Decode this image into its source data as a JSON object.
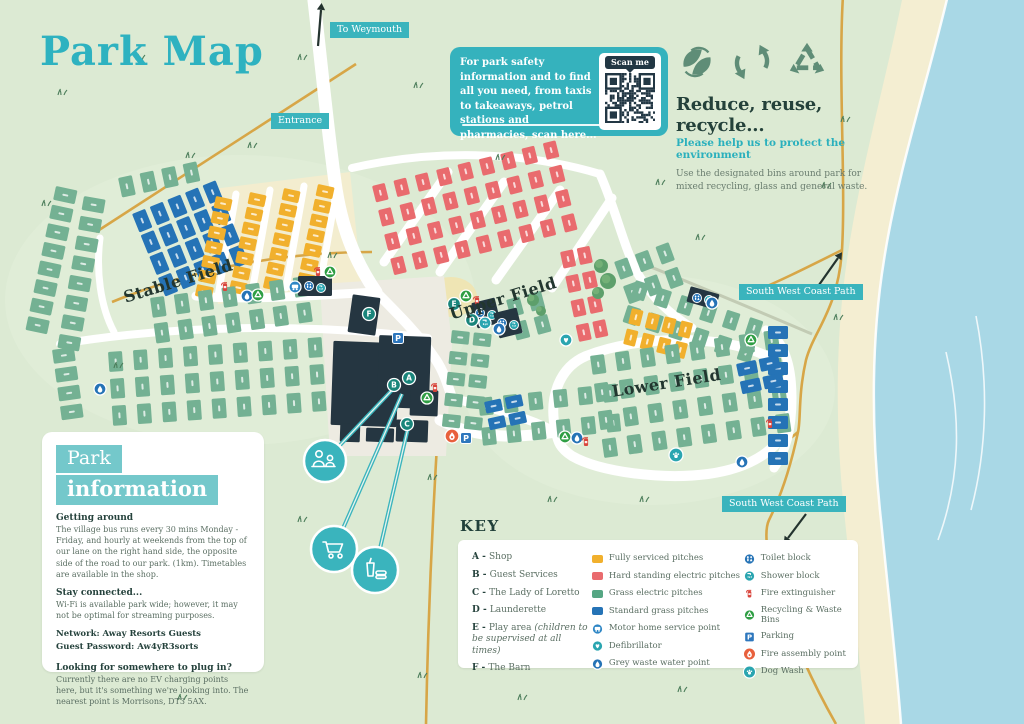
{
  "page": {
    "title": "Park Map"
  },
  "qr_panel": {
    "text": "For park safety information and to find all you need, from taxis to takeaways, petrol stations and pharmacies, scan here...",
    "scan_label": "Scan me"
  },
  "recycle_panel": {
    "heading": "Reduce, reuse, recycle...",
    "subheading": "Please help us to protect the environment",
    "body": "Use the designated bins around park for mixed recycling, glass and general waste."
  },
  "park_info": {
    "title_line1": "Park",
    "title_line2": "information",
    "sections": [
      {
        "heading": "Getting around",
        "body": "The village bus runs every 30 mins Monday - Friday, and hourly at weekends from the top of our lane on the right hand side, the opposite side of the road to our park. (1km). Timetables are available in the shop."
      },
      {
        "heading": "Stay connected...",
        "body": "Wi-Fi is available park wide; however, it may not be optimal for streaming purposes."
      },
      {
        "bold": [
          "Network: Away Resorts Guests",
          "Guest Password: Aw4yR3sorts"
        ]
      },
      {
        "heading": "Looking for somewhere to plug in?",
        "body": "Currently there are no EV charging points here, but it's something we're looking into. The nearest point is Morrisons, DT3 5AX."
      }
    ]
  },
  "key": {
    "title": "KEY",
    "facilities": [
      {
        "letter": "A",
        "label": "Shop"
      },
      {
        "letter": "B",
        "label": "Guest Services"
      },
      {
        "letter": "C",
        "label": "The Lady of Loretto"
      },
      {
        "letter": "D",
        "label": "Launderette"
      },
      {
        "letter": "E",
        "label": "Play area",
        "note": "(children to be supervised at all times)"
      },
      {
        "letter": "F",
        "label": "The Barn"
      }
    ],
    "legend_pitches": [
      {
        "swatch": "yellow",
        "label": "Fully serviced pitches"
      },
      {
        "swatch": "red",
        "label": "Hard standing electric pitches"
      },
      {
        "swatch": "green",
        "label": "Grass electric pitches"
      },
      {
        "swatch": "blue",
        "label": "Standard grass pitches"
      },
      {
        "icon": "motorhome",
        "label": "Motor home service point"
      },
      {
        "icon": "defib",
        "label": "Defibrillator"
      },
      {
        "icon": "greywaste",
        "label": "Grey waste water point"
      }
    ],
    "legend_icons": [
      {
        "icon": "toilet",
        "label": "Toilet block"
      },
      {
        "icon": "shower",
        "label": "Shower block"
      },
      {
        "icon": "fireext",
        "label": "Fire extinguisher"
      },
      {
        "icon": "recycling",
        "label": "Recycling & Waste Bins"
      },
      {
        "icon": "parking",
        "label": "Parking"
      },
      {
        "icon": "fireassembly",
        "label": "Fire assembly point"
      },
      {
        "icon": "dogwash",
        "label": "Dog Wash"
      }
    ]
  },
  "map": {
    "colors": {
      "land": "#dcead3",
      "sea": "#a9d8e6",
      "beach": "#f4eed2",
      "road": "#ffffff",
      "tan": "#d7a647",
      "hedge_gray": "#c2cbb4",
      "building": "#253641",
      "apron": "#edebe2",
      "yellow": "#f1b02d",
      "red": "#e96b6e",
      "green": "#74b193",
      "blue": "#2573b6",
      "key_green": "#55a683",
      "teal": "#3ab4bd",
      "marker": "#19857b",
      "tuft": "#4a7c59"
    },
    "chips": [
      {
        "text": "To Weymouth",
        "x": 330,
        "y": 22
      },
      {
        "text": "Entrance",
        "x": 271,
        "y": 113
      },
      {
        "text": "South West Coast Path",
        "x": 739,
        "y": 284
      },
      {
        "text": "South West Coast Path",
        "x": 722,
        "y": 496
      }
    ],
    "field_labels": [
      {
        "text": "Stable Field",
        "x": 124,
        "y": 288,
        "rot": -17
      },
      {
        "text": "Upper Field",
        "x": 450,
        "y": 305,
        "rot": -17
      },
      {
        "text": "Lower Field",
        "x": 612,
        "y": 382,
        "rot": -9
      }
    ],
    "sea_path": "M948,-5 C928,80 898,170 884,260 C871,340 871,430 881,520 C889,600 897,670 901,724 L1030,724 L1030,-5 Z",
    "beach_path": "M903,-5 C886,80 860,170 847,260 C835,340 835,430 845,520 C853,600 861,670 865,724 L1030,724 L1030,-5 Z",
    "foam_path": "M948,-5 C928,80 898,170 884,260 C871,340 871,430 881,520 C889,600 897,670 901,724",
    "waves": [
      "M946,352 C962,420 960,480 938,540",
      "M976,316 C989,382 987,450 971,510"
    ],
    "cream_patches": [
      {
        "d": "M205,190 L350,172 L362,286 L218,304 Z",
        "fill": "#f3edcf"
      },
      {
        "d": "M425,297 a26,20 0 1,0 52,0 a26,20 0 1,0 -52,0",
        "fill": "#efe5b4"
      }
    ],
    "apron_path": "M320,284 L444,276 L452,344 L446,456 L330,456 Z",
    "roads": [
      {
        "d": "M313,-8 C321,60 327,125 335,182 C341,226 354,260 376,292",
        "w": 13
      },
      {
        "d": "M196,296 C250,301 320,295 376,292",
        "w": 9
      },
      {
        "d": "M236,194 L218,296",
        "w": 7
      },
      {
        "d": "M270,190 L252,292",
        "w": 7
      },
      {
        "d": "M304,186 L286,288",
        "w": 7
      },
      {
        "d": "M338,182 L320,284",
        "w": 7
      },
      {
        "d": "M352,168 C430,150 520,150 600,174",
        "w": 8
      },
      {
        "d": "M384,262 L448,172",
        "w": 9
      },
      {
        "d": "M440,272 L504,182",
        "w": 9
      },
      {
        "d": "M496,280 L560,190",
        "w": 9
      },
      {
        "d": "M552,288 L612,198",
        "w": 9
      },
      {
        "d": "M600,174 C616,210 624,248 638,274 C652,298 670,314 692,328",
        "w": 9
      },
      {
        "d": "M376,292 C400,316 420,336 436,360 C444,372 448,386 452,398",
        "w": 10
      },
      {
        "d": "M440,420 C478,440 520,438 556,432",
        "w": 11
      },
      {
        "d": "M60,344 C170,326 300,322 428,338",
        "w": 8
      },
      {
        "d": "M100,238 C96,270 100,306 114,332",
        "w": 7
      },
      {
        "d": "M452,398 C490,408 520,414 556,432",
        "w": 9
      },
      {
        "d": "M766,330 C786,342 792,368 792,398 C792,428 786,452 774,468",
        "w": 9
      },
      {
        "d": "M556,432 C548,400 558,368 586,356 C642,334 722,336 762,354 C788,364 794,392 790,416 C784,448 752,468 708,474 C662,480 600,472 572,456 C560,448 558,442 556,432 Z",
        "w": 10
      }
    ],
    "tan_paths": [
      "M96,232 L356,64",
      "M112,302 C200,266 290,252 372,252",
      "M843,-5 C838,80 846,180 842,250 C838,310 814,330 806,360 C798,395 801,420 798,432 C790,470 779,500 769,520 C757,545 788,640 836,724",
      "M842,250 C806,268 774,284 748,294",
      "M798,432 C780,448 756,458 738,464",
      "M438,428 C433,510 428,620 426,724"
    ],
    "hedge_gray_path": "M628,258 C690,282 760,312 812,334",
    "clusters": [
      {
        "c": "green",
        "x": 56,
        "y": 186,
        "rows": 8,
        "cols": 1,
        "w": 22,
        "h": 14,
        "dx": 0,
        "dy": 19,
        "rot": 12
      },
      {
        "c": "green",
        "x": 84,
        "y": 196,
        "rows": 8,
        "cols": 1,
        "w": 22,
        "h": 14,
        "dx": 3,
        "dy": 20,
        "rot": 10
      },
      {
        "c": "green",
        "x": 52,
        "y": 350,
        "rows": 4,
        "cols": 1,
        "w": 22,
        "h": 14,
        "dx": 1,
        "dy": 19,
        "rot": -8
      },
      {
        "c": "green",
        "x": 118,
        "y": 178,
        "rows": 1,
        "cols": 4,
        "w": 14,
        "h": 20,
        "dx": 22,
        "dy": 0,
        "rot": -12
      },
      {
        "c": "blue",
        "x": 132,
        "y": 214,
        "rows": 4,
        "cols": 5,
        "w": 14,
        "h": 20,
        "dx": 19,
        "dy": 23,
        "rot": -22
      },
      {
        "c": "yellow",
        "x": 216,
        "y": 196,
        "rows": 7,
        "cols": 1,
        "w": 17,
        "h": 12,
        "dx": 0,
        "dy": 15,
        "rot": 12
      },
      {
        "c": "yellow",
        "x": 250,
        "y": 192,
        "rows": 7,
        "cols": 1,
        "w": 17,
        "h": 12,
        "dx": 0,
        "dy": 15,
        "rot": 12
      },
      {
        "c": "yellow",
        "x": 284,
        "y": 188,
        "rows": 7,
        "cols": 1,
        "w": 17,
        "h": 12,
        "dx": 0,
        "dy": 15,
        "rot": 12
      },
      {
        "c": "yellow",
        "x": 318,
        "y": 184,
        "rows": 7,
        "cols": 1,
        "w": 17,
        "h": 12,
        "dx": 0,
        "dy": 15,
        "rot": 12
      },
      {
        "c": "green",
        "x": 150,
        "y": 298,
        "rows": 2,
        "cols": 7,
        "w": 14,
        "h": 20,
        "dx": 24,
        "dy": 26,
        "rot": -8
      },
      {
        "c": "green",
        "x": 108,
        "y": 352,
        "rows": 3,
        "cols": 9,
        "w": 14,
        "h": 20,
        "dx": 25,
        "dy": 27,
        "rot": -4
      },
      {
        "c": "red",
        "x": 372,
        "y": 186,
        "rows": 4,
        "cols": 9,
        "w": 13,
        "h": 17,
        "dx": 22,
        "dy": 25,
        "rot": -14
      },
      {
        "c": "red",
        "x": 560,
        "y": 252,
        "rows": 4,
        "cols": 2,
        "w": 13,
        "h": 17,
        "dx": 17,
        "dy": 25,
        "rot": -12
      },
      {
        "c": "green",
        "x": 614,
        "y": 262,
        "rows": 2,
        "cols": 3,
        "w": 14,
        "h": 19,
        "dx": 22,
        "dy": 26,
        "rot": -20
      },
      {
        "c": "green",
        "x": 452,
        "y": 330,
        "rows": 5,
        "cols": 2,
        "w": 18,
        "h": 13,
        "dx": 22,
        "dy": 21,
        "rot": 6
      },
      {
        "c": "green",
        "x": 478,
        "y": 398,
        "rows": 2,
        "cols": 6,
        "w": 14,
        "h": 18,
        "dx": 25,
        "dy": 30,
        "rot": -6
      },
      {
        "c": "green",
        "x": 636,
        "y": 280,
        "rows": 2,
        "cols": 6,
        "w": 14,
        "h": 18,
        "dx": 24,
        "dy": 26,
        "rot": 18
      },
      {
        "c": "yellow",
        "x": 632,
        "y": 308,
        "rows": 2,
        "cols": 4,
        "w": 12,
        "h": 16,
        "dx": 17,
        "dy": 21,
        "rot": 14
      },
      {
        "c": "green",
        "x": 590,
        "y": 356,
        "rows": 4,
        "cols": 8,
        "w": 14,
        "h": 19,
        "dx": 25,
        "dy": 28,
        "rot": -8
      },
      {
        "c": "blue",
        "x": 768,
        "y": 326,
        "rows": 8,
        "cols": 1,
        "w": 20,
        "h": 13,
        "dx": 0,
        "dy": 18,
        "rot": 0
      },
      {
        "c": "blue",
        "x": 736,
        "y": 364,
        "rows": 2,
        "cols": 2,
        "w": 20,
        "h": 13,
        "dx": 23,
        "dy": 18,
        "rot": -12
      },
      {
        "c": "blue",
        "x": 484,
        "y": 402,
        "rows": 2,
        "cols": 2,
        "w": 17,
        "h": 12,
        "dx": 21,
        "dy": 17,
        "rot": -12
      },
      {
        "c": "green",
        "x": 506,
        "y": 300,
        "rows": 2,
        "cols": 2,
        "w": 14,
        "h": 18,
        "dx": 22,
        "dy": 24,
        "rot": -15
      }
    ],
    "buildings": [
      {
        "x": 350,
        "y": 296,
        "w": 28,
        "h": 38,
        "rot": 8
      },
      {
        "x": 332,
        "y": 342,
        "w": 66,
        "h": 84,
        "rot": 2
      },
      {
        "x": 378,
        "y": 336,
        "w": 52,
        "h": 72,
        "rot": 2
      },
      {
        "x": 340,
        "y": 424,
        "w": 20,
        "h": 18,
        "rot": 2
      },
      {
        "x": 366,
        "y": 428,
        "w": 28,
        "h": 14,
        "rot": 2
      },
      {
        "x": 396,
        "y": 420,
        "w": 32,
        "h": 22,
        "rot": 2
      },
      {
        "x": 410,
        "y": 390,
        "w": 28,
        "h": 26,
        "rot": 2
      },
      {
        "x": 474,
        "y": 300,
        "w": 24,
        "h": 26,
        "rot": -14,
        "icons": true
      },
      {
        "x": 496,
        "y": 310,
        "w": 24,
        "h": 26,
        "rot": -14,
        "icons": true
      },
      {
        "x": 298,
        "y": 276,
        "w": 34,
        "h": 20,
        "rot": 0,
        "icons": true
      },
      {
        "x": 688,
        "y": 290,
        "w": 30,
        "h": 16,
        "rot": 16,
        "icons": true
      }
    ],
    "trees": [
      [
        601,
        266,
        7
      ],
      [
        608,
        281,
        8
      ],
      [
        598,
        293,
        6
      ],
      [
        533,
        300,
        6
      ],
      [
        541,
        311,
        5
      ]
    ],
    "grass": [
      [
        418,
        88
      ],
      [
        302,
        60
      ],
      [
        140,
        60
      ],
      [
        62,
        95
      ],
      [
        190,
        158
      ],
      [
        46,
        206
      ],
      [
        252,
        148
      ],
      [
        500,
        160
      ],
      [
        660,
        185
      ],
      [
        826,
        188
      ],
      [
        700,
        240
      ],
      [
        845,
        122
      ],
      [
        644,
        502
      ],
      [
        552,
        502
      ],
      [
        302,
        522
      ],
      [
        252,
        618
      ],
      [
        422,
        678
      ],
      [
        522,
        700
      ],
      [
        682,
        692
      ],
      [
        182,
        700
      ],
      [
        82,
        620
      ],
      [
        432,
        480
      ],
      [
        770,
        560
      ],
      [
        838,
        320
      ],
      [
        332,
        258
      ],
      [
        118,
        368
      ],
      [
        586,
        608
      ],
      [
        760,
        640
      ]
    ],
    "markers": [
      [
        369,
        314,
        "F"
      ],
      [
        398,
        338,
        "parking"
      ],
      [
        394,
        385,
        "B"
      ],
      [
        409,
        378,
        "A"
      ],
      [
        427,
        398,
        "recycling"
      ],
      [
        435,
        388,
        "fireext"
      ],
      [
        407,
        424,
        "C"
      ],
      [
        452,
        436,
        "fireassembly"
      ],
      [
        466,
        438,
        "parking"
      ],
      [
        454,
        304,
        "E"
      ],
      [
        466,
        296,
        "recycling"
      ],
      [
        477,
        301,
        "fireext"
      ],
      [
        472,
        320,
        "D"
      ],
      [
        485,
        323,
        "shower"
      ],
      [
        499,
        329,
        "greywaste"
      ],
      [
        295,
        287,
        "motorhome"
      ],
      [
        247,
        296,
        "greywaste"
      ],
      [
        258,
        295,
        "recycling"
      ],
      [
        225,
        287,
        "fireext"
      ],
      [
        318,
        272,
        "fireext"
      ],
      [
        330,
        272,
        "recycling"
      ],
      [
        100,
        389,
        "greywaste"
      ],
      [
        751,
        340,
        "recycling"
      ],
      [
        770,
        424,
        "fireext"
      ],
      [
        742,
        462,
        "greywaste"
      ],
      [
        676,
        455,
        "dogwash"
      ],
      [
        712,
        303,
        "greywaste"
      ],
      [
        566,
        340,
        "defib"
      ],
      [
        565,
        437,
        "recycling"
      ],
      [
        577,
        438,
        "greywaste"
      ],
      [
        586,
        442,
        "fireext"
      ]
    ],
    "callouts": [
      {
        "icon": "people",
        "x": 325,
        "y": 461,
        "r": 21,
        "tx": 394,
        "ty": 388
      },
      {
        "icon": "cart",
        "x": 334,
        "y": 549,
        "r": 23,
        "tx": 402,
        "ty": 394
      },
      {
        "icon": "drink",
        "x": 375,
        "y": 570,
        "r": 23,
        "tx": 408,
        "ty": 428
      }
    ],
    "arrows": [
      [
        318,
        46,
        321,
        10
      ],
      [
        814,
        292,
        838,
        258
      ],
      [
        806,
        514,
        788,
        538
      ]
    ]
  }
}
